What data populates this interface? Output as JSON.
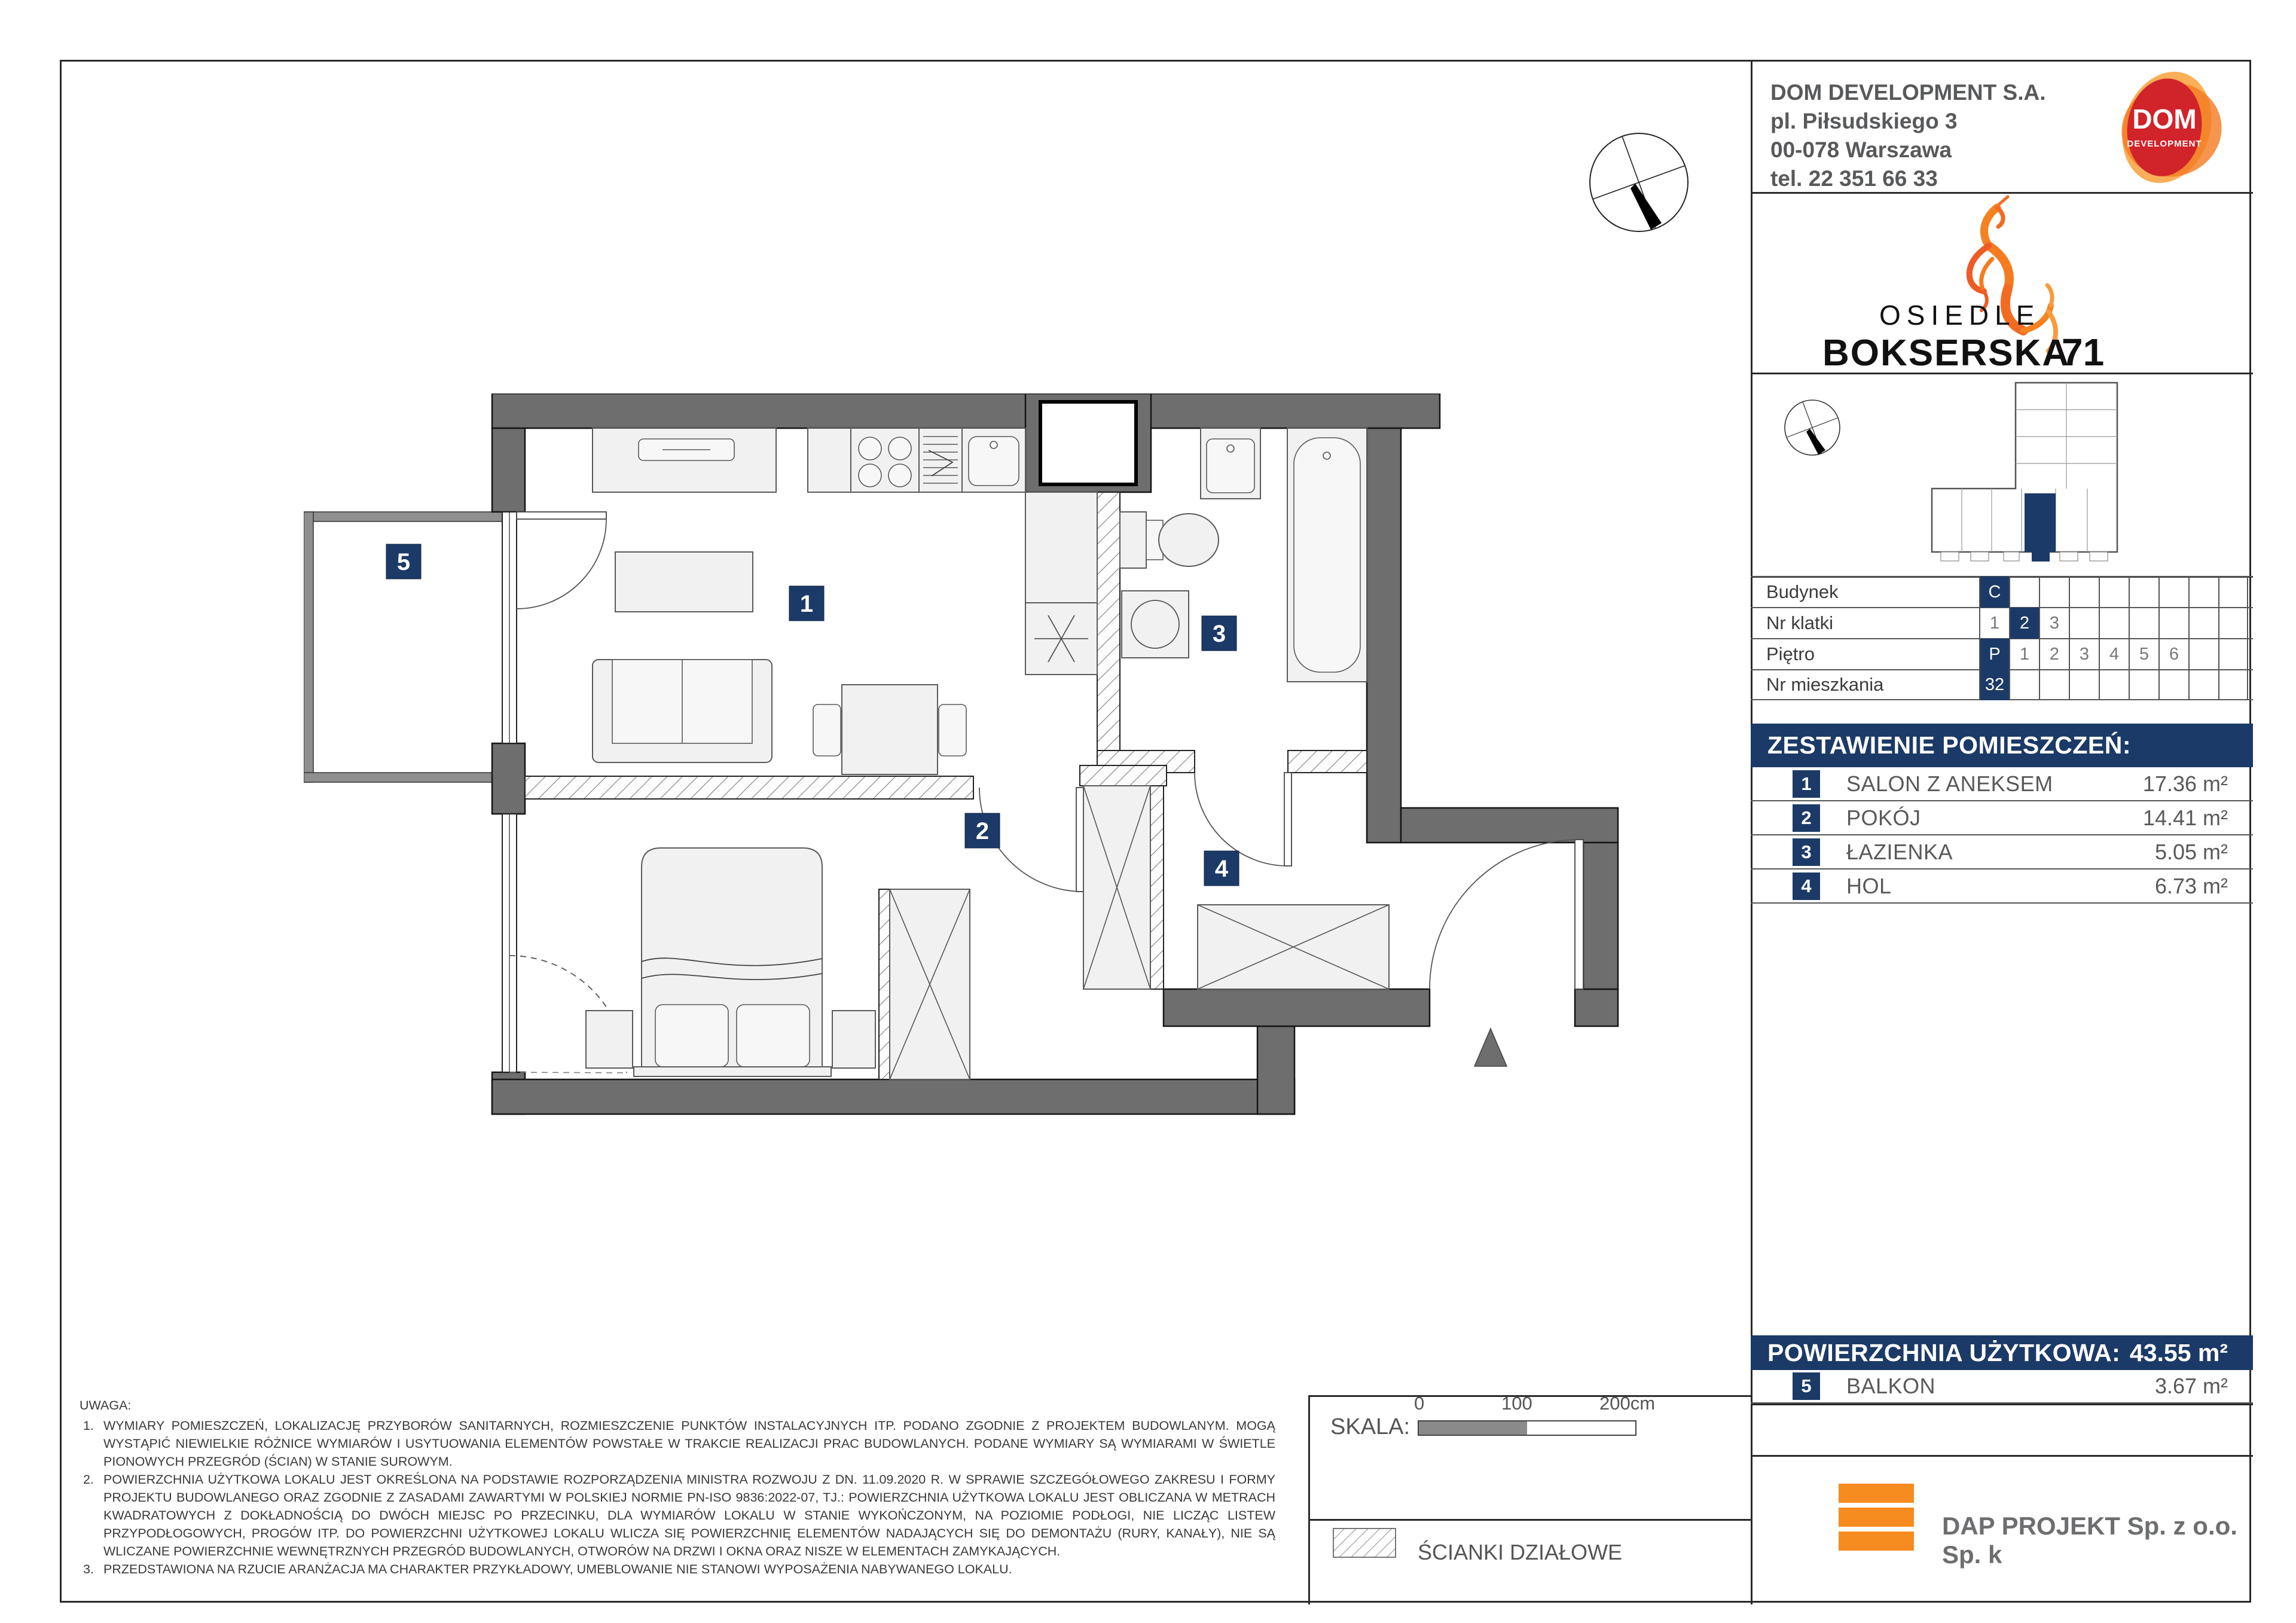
{
  "header": {
    "company": "DOM DEVELOPMENT S.A.",
    "address1": "pl. Piłsudskiego 3",
    "address2": "00-078 Warszawa",
    "phone": "tel. 22 351 66 33",
    "logo_word": "DOM",
    "logo_sub": "DEVELOPMENT"
  },
  "project": {
    "line1": "OSIEDLE",
    "line2": "BOKSERSKA",
    "number": "71"
  },
  "unit_table": {
    "rows": [
      {
        "label": "Budynek",
        "highlight_index": 0,
        "cells": [
          "C",
          "",
          "",
          "",
          "",
          "",
          "",
          "",
          ""
        ]
      },
      {
        "label": "Nr klatki",
        "highlight_index": 1,
        "cells": [
          "1",
          "2",
          "3",
          "",
          "",
          "",
          "",
          "",
          ""
        ]
      },
      {
        "label": "Piętro",
        "highlight_index": 0,
        "cells": [
          "P",
          "1",
          "2",
          "3",
          "4",
          "5",
          "6",
          "",
          ""
        ]
      },
      {
        "label": "Nr mieszkania",
        "highlight_index": 0,
        "cells": [
          "32",
          "",
          "",
          "",
          "",
          "",
          "",
          "",
          ""
        ]
      }
    ]
  },
  "rooms": {
    "title": "ZESTAWIENIE POMIESZCZEŃ:",
    "items": [
      {
        "no": "1",
        "name": "SALON Z ANEKSEM",
        "area": "17.36 m²"
      },
      {
        "no": "2",
        "name": "POKÓJ",
        "area": "14.41 m²"
      },
      {
        "no": "3",
        "name": "ŁAZIENKA",
        "area": "5.05 m²"
      },
      {
        "no": "4",
        "name": "HOL",
        "area": "6.73 m²"
      }
    ]
  },
  "summary": {
    "label": "POWIERZCHNIA UŻYTKOWA:",
    "value": "43.55 m²"
  },
  "balcony": {
    "no": "5",
    "name": "BALKON",
    "area": "3.67 m²"
  },
  "notes": {
    "title": "UWAGA:",
    "items": [
      "WYMIARY POMIESZCZEŃ, LOKALIZACJĘ PRZYBORÓW SANITARNYCH, ROZMIESZCZENIE PUNKTÓW INSTALACYJNYCH ITP. PODANO ZGODNIE Z PROJEKTEM BUDOWLANYM. MOGĄ WYSTĄPIĆ NIEWIELKIE RÓŻNICE WYMIARÓW I USYTUOWANIA ELEMENTÓW POWSTAŁE W TRAKCIE REALIZACJI PRAC BUDOWLANYCH. PODANE WYMIARY SĄ WYMIARAMI W ŚWIETLE PIONOWYCH PRZEGRÓD (ŚCIAN) W STANIE SUROWYM.",
      "POWIERZCHNIA UŻYTKOWA LOKALU JEST OKREŚLONA NA PODSTAWIE ROZPORZĄDZENIA MINISTRA ROZWOJU Z DN. 11.09.2020 R. W SPRAWIE SZCZEGÓŁOWEGO ZAKRESU I FORMY PROJEKTU BUDOWLANEGO ORAZ ZGODNIE Z ZASADAMI ZAWARTYMI W POLSKIEJ NORMIE PN-ISO 9836:2022-07, TJ.: POWIERZCHNIA UŻYTKOWA LOKALU JEST OBLICZANA W METRACH KWADRATOWYCH Z DOKŁADNOŚCIĄ DO DWÓCH MIEJSC PO PRZECINKU, DLA WYMIARÓW LOKALU W STANIE WYKOŃCZONYM, NA POZIOMIE PODŁOGI, NIE LICZĄC LISTEW PRZYPODŁOGOWYCH, PROGÓW ITP. DO POWIERZCHNI UŻYTKOWEJ LOKALU WLICZA SIĘ POWIERZCHNIĘ ELEMENTÓW NADAJĄCYCH SIĘ DO DEMONTAŻU (RURY, KANAŁY), NIE SĄ WLICZANE POWIERZCHNIE WEWNĘTRZNYCH PRZEGRÓD BUDOWLANYCH, OTWORÓW NA DRZWI I OKNA ORAZ NISZE W ELEMENTACH ZAMYKAJĄCYCH.",
      "PRZEDSTAWIONA NA RZUCIE ARANŻACJA MA CHARAKTER PRZYKŁADOWY, UMEBLOWANIE NIE STANOWI WYPOSAŻENIA NABYWANEGO LOKALU."
    ],
    "numbers": [
      "1.",
      "2.",
      "3."
    ]
  },
  "scale_bar": {
    "label": "SKALA:",
    "tick0": "0",
    "tick1": "100",
    "tick2": "200cm"
  },
  "legend": {
    "partitions": "ŚCIANKI DZIAŁOWE"
  },
  "designer": {
    "name": "DAP PROJEKT Sp. z o.o. Sp. k"
  },
  "plan": {
    "labels": {
      "l1": "1",
      "l2": "2",
      "l3": "3",
      "l4": "4",
      "l5": "5"
    }
  },
  "colors": {
    "navy": "#1b3a67",
    "wall_gray": "#6e6e6e",
    "dap_orange": "#f68b1f",
    "dom_red": "#d1232a"
  }
}
